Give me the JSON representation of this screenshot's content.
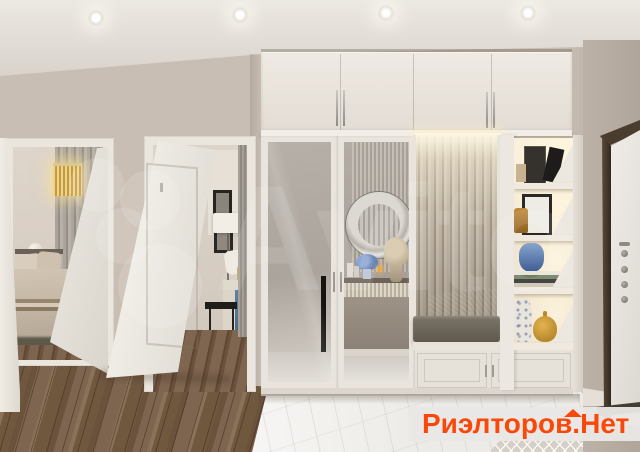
{
  "scene": {
    "description": "3D render of an apartment hallway: two open white doors to bedrooms on the left, built-in cream wardrobe with mirrored doors, fluted seating niche with lit shelving, dark-framed entrance door on the right",
    "palette": {
      "wall": "#c9beb3",
      "ceiling": "#e6e2dc",
      "wardrobe": "#e8e3dc",
      "fluted_panel": "#a89e91",
      "bench_cushion": "#6e6759",
      "wood_floor": "#7a614c",
      "marble_floor": "#edebe7",
      "led_glow": "#fff3d6",
      "entrance_door_frame": "#46392c",
      "watermark_orange": "#f8490b"
    }
  },
  "watermarks": {
    "avito_text": "Avito",
    "realtor_part1": "Риэлторов.",
    "realtor_part2": "Нет"
  }
}
